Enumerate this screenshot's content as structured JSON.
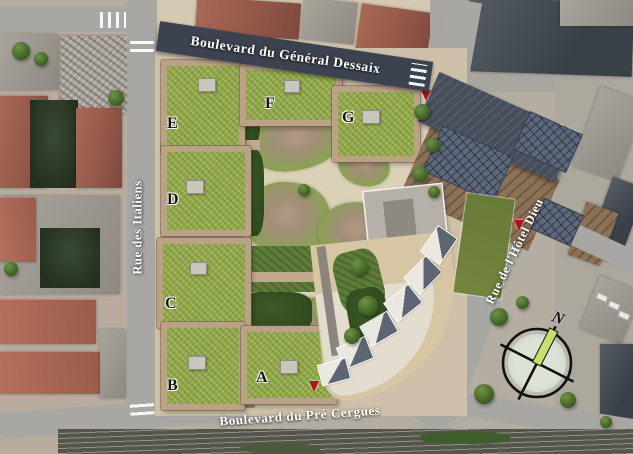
{
  "streets": {
    "top": {
      "label": "Boulevard du Général Dessaix"
    },
    "left": {
      "label": "Rue des Italiens"
    },
    "right": {
      "label": "Rue de l'Hôtel Dieu"
    },
    "bottom": {
      "label": "Boulevard du Pré Cergues"
    }
  },
  "buildings": [
    {
      "label": "A"
    },
    {
      "label": "B"
    },
    {
      "label": "C"
    },
    {
      "label": "D"
    },
    {
      "label": "E"
    },
    {
      "label": "F"
    },
    {
      "label": "G"
    }
  ],
  "compass": {
    "north_label": "N"
  },
  "colors": {
    "banner": "#3c4350",
    "road": "#a8a7a3",
    "roof_green": "#95aa4f",
    "terrace": "#bba287",
    "sand": "#dbd1b6",
    "parcel": "#cfc1a9",
    "court_green": "#2f4a1e",
    "field": "#74853e",
    "dark_roof": "#454e5a",
    "timber": "#8b7257",
    "solar": "#5c6779",
    "needle": "#c6e069",
    "marker": "#b5121b",
    "railway": "#54554b"
  }
}
